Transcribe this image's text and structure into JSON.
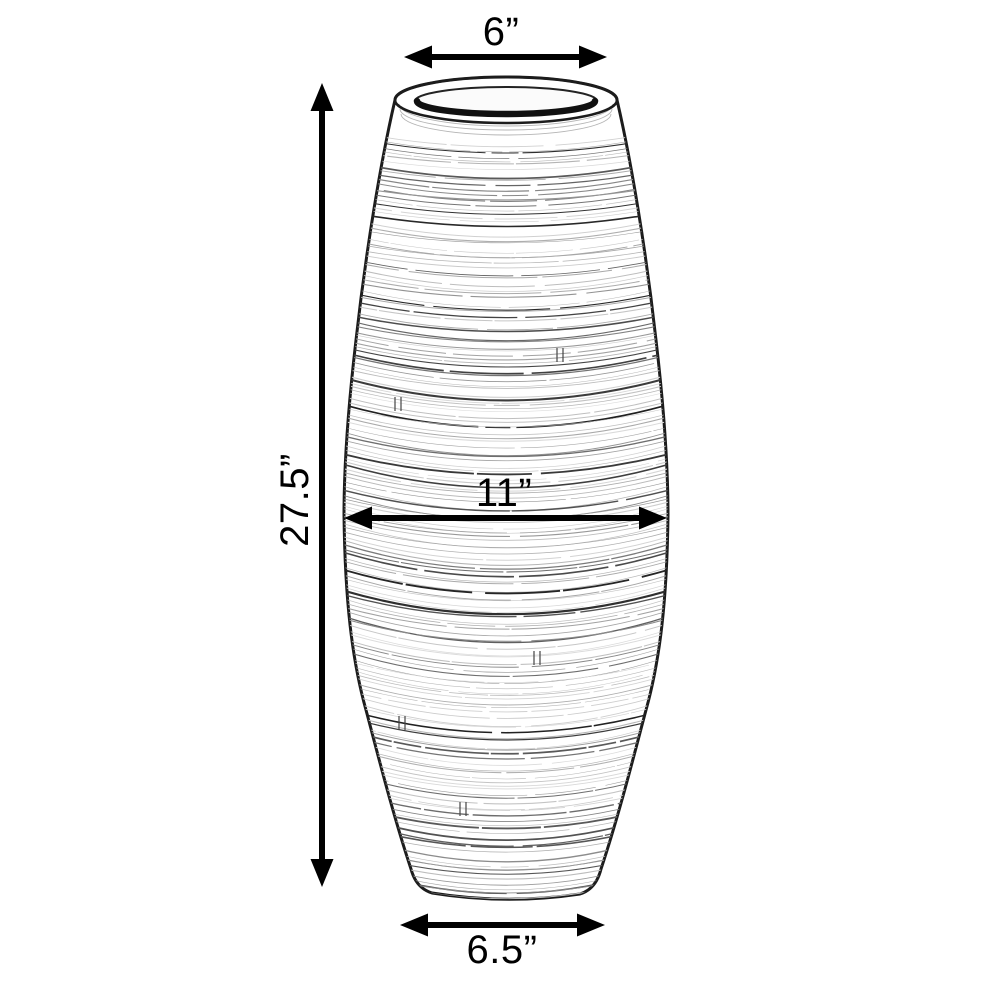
{
  "diagram": {
    "kind": "product-dimension-diagram",
    "subject": "textured vase line drawing",
    "dimensions": {
      "top_diameter": {
        "label": "6”",
        "value_inches": 6
      },
      "height": {
        "label": "27.5”",
        "value_inches": 27.5
      },
      "max_diameter": {
        "label": "11”",
        "value_inches": 11
      },
      "base_diameter": {
        "label": "6.5”",
        "value_inches": 6.5
      }
    }
  },
  "colors": {
    "ink": "#000000",
    "outline": "#1c1c1c",
    "bg": "#ffffff"
  }
}
